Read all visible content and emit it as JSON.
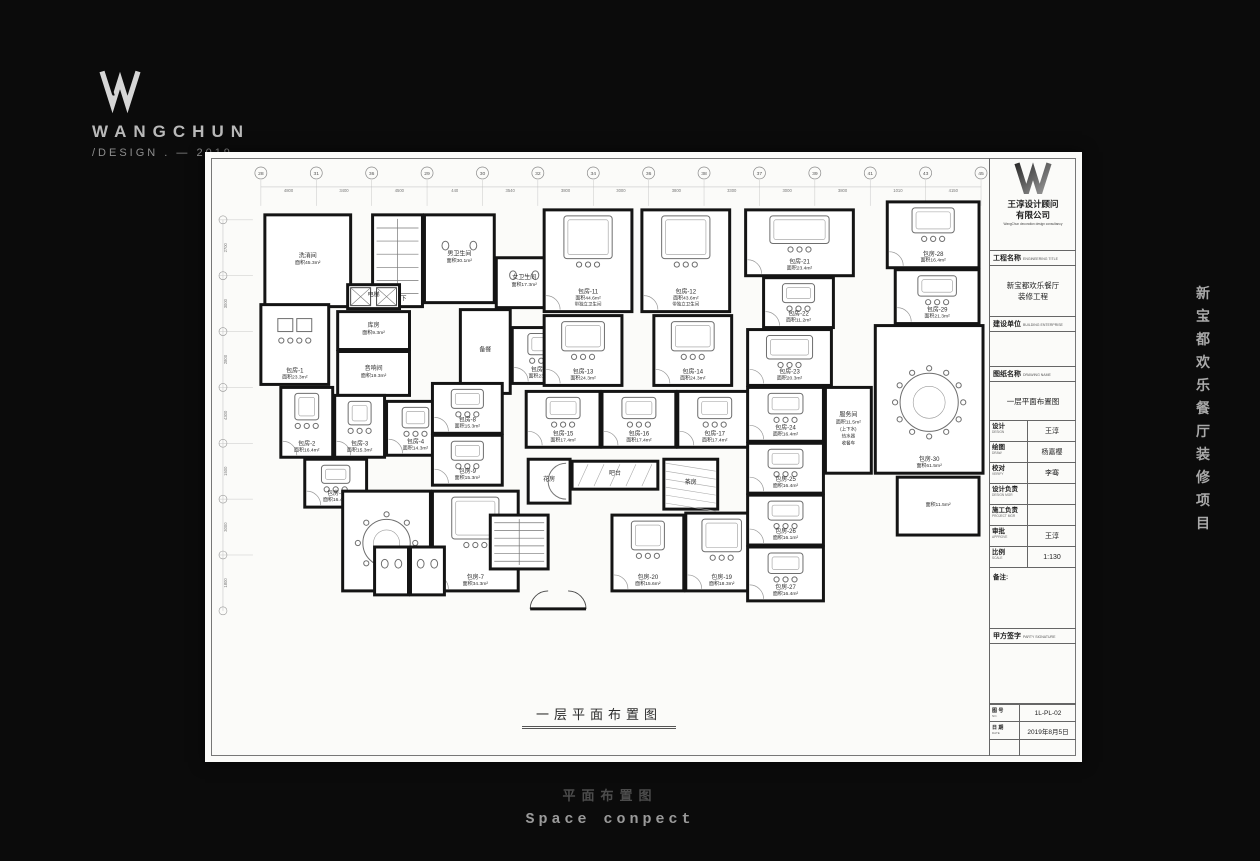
{
  "logo": {
    "brand": "WANGCHUN",
    "tagline": "/DESIGN . — 2019"
  },
  "side_project_text": [
    "新",
    "宝",
    "都",
    "欢",
    "乐",
    "餐",
    "厅",
    "装",
    "修",
    "项",
    "目"
  ],
  "footer": {
    "cn": "平面布置图",
    "en": "Space conpect"
  },
  "drawing": {
    "caption": "一层平面布置图",
    "grid": {
      "top_bubbles": [
        "28",
        "31",
        "36",
        "29",
        "30",
        "32",
        "34",
        "36",
        "38",
        "37",
        "39",
        "41",
        "43",
        "45"
      ],
      "top_dims": [
        "4800",
        "3400",
        "4500",
        "440",
        "3540",
        "3800",
        "3000",
        "3800",
        "3300",
        "3000",
        "3800",
        "1010",
        "4150"
      ],
      "left_dims": [
        "2700",
        "3000",
        "2800",
        "4300",
        "1500",
        "3000",
        "1800"
      ]
    },
    "rooms": [
      {
        "label": "洗消间",
        "area": "面积45.3m²",
        "x": 52,
        "y": 55,
        "w": 86,
        "h": 92,
        "f": "none"
      },
      {
        "label": "下地下",
        "area": "",
        "x": 160,
        "y": 55,
        "w": 50,
        "h": 92,
        "f": "stair"
      },
      {
        "label": "男卫生间",
        "area": "面积30.1m²",
        "x": 212,
        "y": 55,
        "w": 70,
        "h": 88,
        "f": "wc"
      },
      {
        "label": "女卫生间",
        "area": "面积17.3m²",
        "x": 284,
        "y": 98,
        "w": 56,
        "h": 50,
        "f": "wc"
      },
      {
        "label": "电梯",
        "area": "",
        "x": 135,
        "y": 125,
        "w": 52,
        "h": 24,
        "f": "elev"
      },
      {
        "label": "库房",
        "area": "面积9.3m²",
        "x": 125,
        "y": 152,
        "w": 72,
        "h": 38,
        "f": "none"
      },
      {
        "label": "音响间",
        "area": "面积19.3m²",
        "x": 125,
        "y": 192,
        "w": 72,
        "h": 44,
        "f": "none"
      },
      {
        "label": "备餐",
        "area": "",
        "x": 248,
        "y": 150,
        "w": 50,
        "h": 84,
        "f": "none"
      },
      {
        "label": "包房-1",
        "area": "面积23.3m²",
        "x": 48,
        "y": 145,
        "w": 68,
        "h": 80,
        "f": "table2"
      },
      {
        "label": "包房-2",
        "area": "面积16.4m²",
        "x": 68,
        "y": 228,
        "w": 52,
        "h": 70,
        "f": "sofa"
      },
      {
        "label": "包房-3",
        "area": "面积15.3m²",
        "x": 122,
        "y": 236,
        "w": 50,
        "h": 62,
        "f": "sofa"
      },
      {
        "label": "包房-4",
        "area": "面积14.3m²",
        "x": 174,
        "y": 242,
        "w": 58,
        "h": 54,
        "f": "sofa"
      },
      {
        "label": "包房-5",
        "area": "面积16.4m²",
        "x": 92,
        "y": 300,
        "w": 62,
        "h": 48,
        "f": "sofa"
      },
      {
        "label": "包房-6",
        "area": "面积34.3m²",
        "x": 130,
        "y": 332,
        "w": 88,
        "h": 100,
        "f": "round10"
      },
      {
        "label": "包房-7",
        "area": "面积34.3m²",
        "x": 220,
        "y": 332,
        "w": 86,
        "h": 100,
        "f": "sofa2"
      },
      {
        "label": "包房-8",
        "area": "面积15.3m²",
        "x": 220,
        "y": 224,
        "w": 70,
        "h": 50,
        "f": "sofa"
      },
      {
        "label": "包房-9",
        "area": "面积15.3m²",
        "x": 220,
        "y": 276,
        "w": 70,
        "h": 50,
        "f": "sofa"
      },
      {
        "label": "包房-10",
        "area": "面积23.3m²",
        "x": 300,
        "y": 168,
        "w": 58,
        "h": 56,
        "f": "sofa"
      },
      {
        "label": "包房-11",
        "area": "面积44.6m²",
        "sub": "带独立卫生间",
        "x": 332,
        "y": 50,
        "w": 88,
        "h": 102,
        "f": "bigsofa"
      },
      {
        "label": "包房-12",
        "area": "面积43.6m²",
        "sub": "带独立卫生间",
        "x": 430,
        "y": 50,
        "w": 88,
        "h": 102,
        "f": "bigsofa"
      },
      {
        "label": "包房-13",
        "area": "面积24.3m²",
        "x": 332,
        "y": 156,
        "w": 78,
        "h": 70,
        "f": "sofa2"
      },
      {
        "label": "包房-14",
        "area": "面积24.3m²",
        "x": 442,
        "y": 156,
        "w": 78,
        "h": 70,
        "f": "sofa2"
      },
      {
        "label": "包房-15",
        "area": "面积17.4m²",
        "x": 314,
        "y": 232,
        "w": 74,
        "h": 56,
        "f": "sofa"
      },
      {
        "label": "包房-16",
        "area": "面积17.4m²",
        "x": 390,
        "y": 232,
        "w": 74,
        "h": 56,
        "f": "sofa"
      },
      {
        "label": "包房-17",
        "area": "面积17.4m²",
        "x": 466,
        "y": 232,
        "w": 74,
        "h": 56,
        "f": "sofa"
      },
      {
        "label": "花房",
        "area": "",
        "x": 316,
        "y": 300,
        "w": 42,
        "h": 44,
        "f": "halfround"
      },
      {
        "label": "吧台",
        "area": "",
        "x": 360,
        "y": 302,
        "w": 86,
        "h": 28,
        "f": "bar"
      },
      {
        "label": "茶房",
        "area": "",
        "x": 452,
        "y": 300,
        "w": 54,
        "h": 50,
        "f": "hatch"
      },
      {
        "label": "包房-19",
        "area": "面积18.3m²",
        "x": 474,
        "y": 354,
        "w": 72,
        "h": 78,
        "f": "sofa2"
      },
      {
        "label": "包房-20",
        "area": "面积15.6m²",
        "x": 400,
        "y": 356,
        "w": 72,
        "h": 76,
        "f": "sofa"
      },
      {
        "label": "",
        "area": "",
        "x": 278,
        "y": 356,
        "w": 58,
        "h": 54,
        "f": "stair"
      },
      {
        "label": "",
        "area": "",
        "x": 162,
        "y": 388,
        "w": 34,
        "h": 48,
        "f": "wc"
      },
      {
        "label": "",
        "area": "",
        "x": 198,
        "y": 388,
        "w": 34,
        "h": 48,
        "f": "wc"
      },
      {
        "label": "包房-21",
        "area": "面积23.4m²",
        "x": 534,
        "y": 50,
        "w": 108,
        "h": 66,
        "f": "sofa2"
      },
      {
        "label": "包房-22",
        "area": "面积11.2m²",
        "x": 552,
        "y": 118,
        "w": 70,
        "h": 50,
        "f": "sofa"
      },
      {
        "label": "包房-23",
        "area": "面积20.3m²",
        "x": 536,
        "y": 170,
        "w": 84,
        "h": 56,
        "f": "sofa2"
      },
      {
        "label": "包房-24",
        "area": "面积16.4m²",
        "x": 536,
        "y": 228,
        "w": 76,
        "h": 54,
        "f": "sofa"
      },
      {
        "label": "包房-25",
        "area": "面积16.4m²",
        "x": 536,
        "y": 284,
        "w": 76,
        "h": 50,
        "f": "sofa"
      },
      {
        "label": "包房-26",
        "area": "面积16.1m²",
        "x": 536,
        "y": 336,
        "w": 76,
        "h": 50,
        "f": "sofa"
      },
      {
        "label": "包房-27",
        "area": "面积16.4m²",
        "x": 536,
        "y": 388,
        "w": 76,
        "h": 54,
        "f": "sofa"
      },
      {
        "label": "服务间",
        "area": "面积11.5m²",
        "sub": "(上下水)\n热水器\n收餐车",
        "x": 614,
        "y": 228,
        "w": 46,
        "h": 86,
        "f": "none"
      },
      {
        "label": "包房-28",
        "area": "面积16.4m²",
        "x": 676,
        "y": 42,
        "w": 92,
        "h": 66,
        "f": "sofa"
      },
      {
        "label": "包房-29",
        "area": "面积21.3m²",
        "x": 684,
        "y": 110,
        "w": 84,
        "h": 54,
        "f": "sofa"
      },
      {
        "label": "包房-30",
        "area": "面积61.5m²",
        "x": 664,
        "y": 166,
        "w": 108,
        "h": 148,
        "f": "round14"
      },
      {
        "label": "",
        "area": "面积11.5m²",
        "x": 686,
        "y": 318,
        "w": 82,
        "h": 58,
        "f": "none"
      }
    ]
  },
  "titleblock": {
    "company_line1": "王淳设计顾问",
    "company_line2": "有限公司",
    "company_en": "WangChun decoration design consultancy",
    "project_label": "工程名称",
    "project_sub": "ENGINEERING TITLE",
    "project_value_line1": "新宝都欢乐餐厅",
    "project_value_line2": "装修工程",
    "client_label": "建设单位",
    "client_sub": "BUILDING ENTERPRISE",
    "sheet_label": "图纸名称",
    "sheet_sub": "DRAWING NAME",
    "sheet_value": "一层平面布置图",
    "rows": [
      {
        "label": "设计",
        "sub": "DESIGN",
        "value": "王淳"
      },
      {
        "label": "绘图",
        "sub": "DRAW",
        "value": "杨嘉樱"
      },
      {
        "label": "校对",
        "sub": "VERIFY",
        "value": "李骞"
      },
      {
        "label": "设计负责",
        "sub": "DESIGN MGR",
        "value": ""
      },
      {
        "label": "施工负责",
        "sub": "PROJECT MGR",
        "value": ""
      },
      {
        "label": "审批",
        "sub": "APPROVE",
        "value": "王淳"
      },
      {
        "label": "比例",
        "sub": "SCALE",
        "value": "1:130"
      }
    ],
    "remark_label": "备注:",
    "sign_label": "甲方签字",
    "sign_sub": "PARTY SIGNATURE",
    "no_label": "图 号",
    "no_sub": "NO.",
    "no_value": "1L-PL-02",
    "date_label": "日 期",
    "date_sub": "DATE",
    "date_value": "2019年8月5日"
  }
}
